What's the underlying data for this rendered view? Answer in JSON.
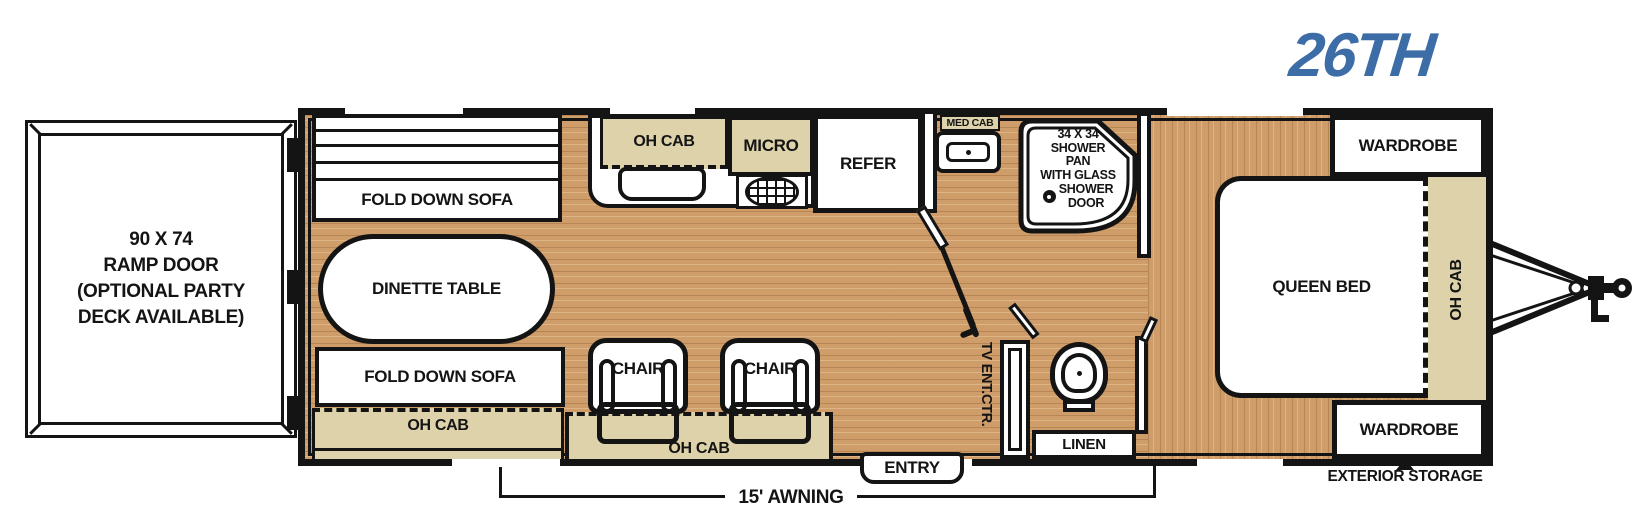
{
  "model_badge": "26TH",
  "colors": {
    "logo_blue": "#3d6da6",
    "cabinet_tan": "#ddd2aa",
    "wall_black": "#141414",
    "floor_base": "#cf9d6a"
  },
  "garage": {
    "ramp_door_lines": [
      "90 X 74",
      "RAMP DOOR",
      "(OPTIONAL PARTY",
      "DECK AVAILABLE)"
    ],
    "sofa_top_label": "FOLD DOWN SOFA",
    "dinette_label": "DINETTE TABLE",
    "sofa_bottom_label": "FOLD DOWN SOFA",
    "oh_cab_label": "OH CAB"
  },
  "kitchen": {
    "oh_cab_label": "OH CAB",
    "micro_label": "MICRO",
    "refer_label": "REFER"
  },
  "living": {
    "chair_left_label": "CHAIR",
    "chair_right_label": "CHAIR",
    "oh_cab_label": "OH CAB",
    "tv_center_label": "TV ENT.CTR."
  },
  "bath": {
    "med_cab_label": "MED CAB",
    "shower_lines": [
      "34 X 34",
      "SHOWER",
      "PAN",
      "WITH GLASS"
    ],
    "shower_door_lines": [
      "SHOWER",
      "DOOR"
    ],
    "linen_label": "LINEN"
  },
  "bedroom": {
    "queen_bed_label": "QUEEN BED",
    "wardrobe_top_label": "WARDROBE",
    "wardrobe_bottom_label": "WARDROBE",
    "oh_cab_label": "OH CAB"
  },
  "exterior": {
    "entry_label": "ENTRY",
    "awning_label": "15' AWNING",
    "storage_label": "EXTERIOR STORAGE"
  }
}
